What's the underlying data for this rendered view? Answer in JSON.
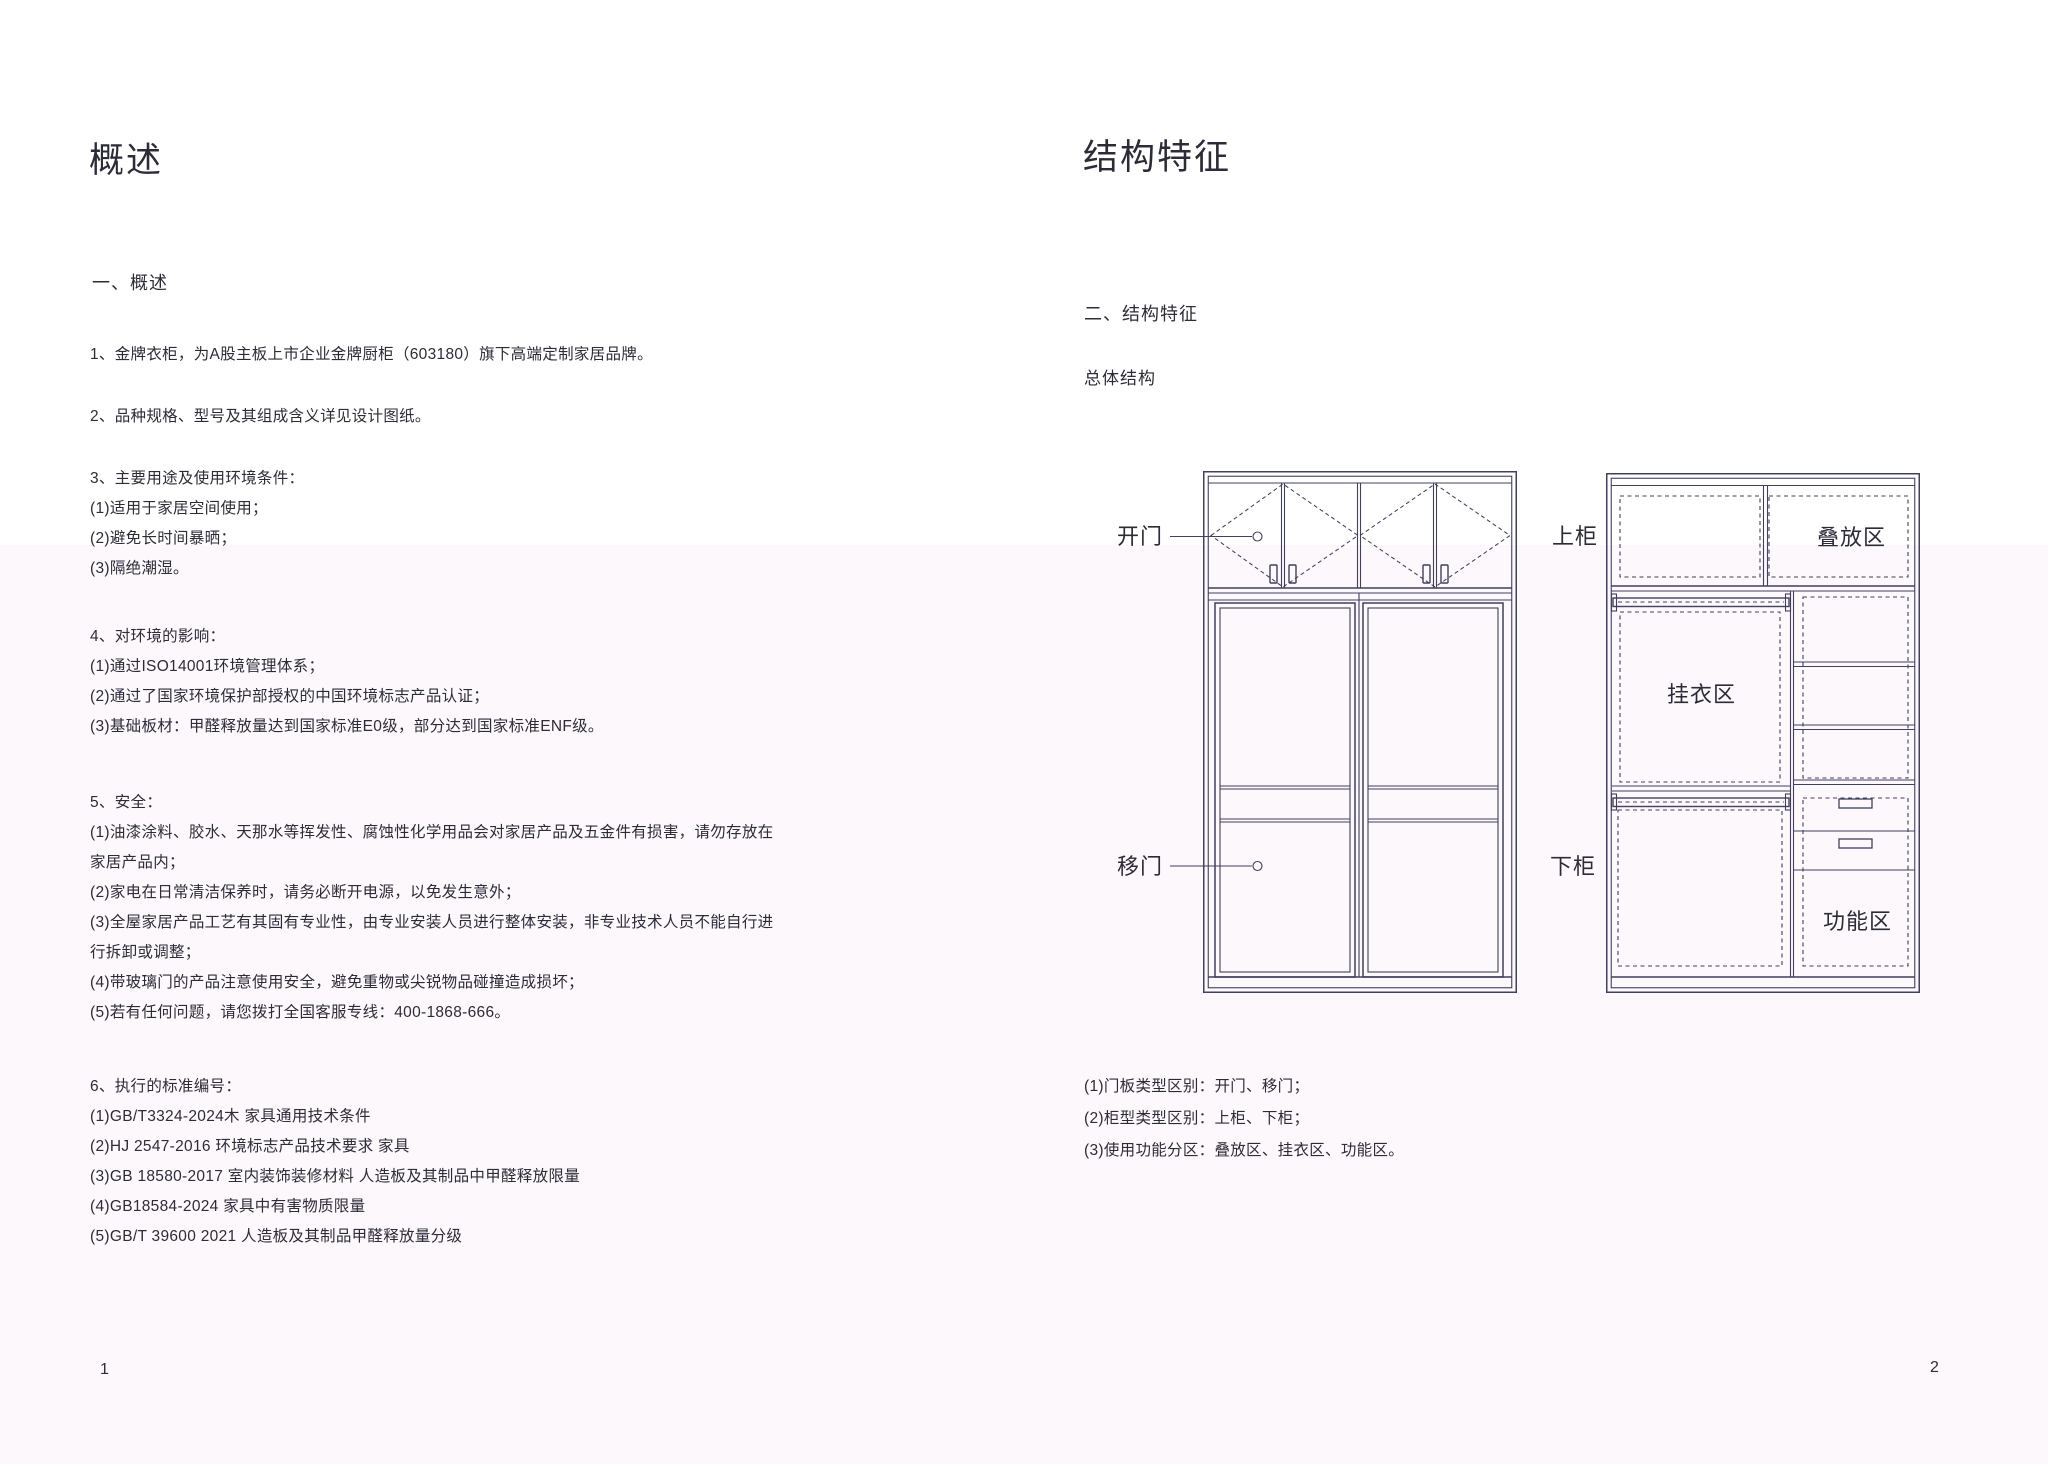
{
  "colors": {
    "background": "#ffffff",
    "tint_band": "#fdf8fb",
    "line": "#40405f",
    "text": "#2c2c38"
  },
  "left_page": {
    "title": "概述",
    "section_heading": "一、概述",
    "para1": "1、金牌衣柜，为A股主板上市企业金牌厨柜（603180）旗下高端定制家居品牌。",
    "para2": "2、品种规格、型号及其组成含义详见设计图纸。",
    "section3": {
      "heading": "3、主要用途及使用环境条件：",
      "items": [
        "(1)适用于家居空间使用；",
        "(2)避免长时间暴晒；",
        "(3)隔绝潮湿。"
      ]
    },
    "section4": {
      "heading": "4、对环境的影响：",
      "items": [
        "(1)通过ISO14001环境管理体系；",
        "(2)通过了国家环境保护部授权的中国环境标志产品认证；",
        "(3)基础板材：甲醛释放量达到国家标准E0级，部分达到国家标准ENF级。"
      ]
    },
    "section5": {
      "heading": "5、安全：",
      "lines": [
        "(1)油漆涂料、胶水、天那水等挥发性、腐蚀性化学用品会对家居产品及五金件有损害，请勿存放在",
        "家居产品内；",
        "(2)家电在日常清洁保养时，请务必断开电源，以免发生意外；",
        "(3)全屋家居产品工艺有其固有专业性，由专业安装人员进行整体安装，非专业技术人员不能自行进",
        "行拆卸或调整；",
        "(4)带玻璃门的产品注意使用安全，避免重物或尖锐物品碰撞造成损坏；",
        "(5)若有任何问题，请您拨打全国客服专线：400-1868-666。"
      ]
    },
    "section6": {
      "heading": "6、执行的标准编号：",
      "items": [
        "(1)GB/T3324-2024木 家具通用技术条件",
        "(2)HJ 2547-2016 环境标志产品技术要求 家具",
        "(3)GB 18580-2017 室内装饰装修材料 人造板及其制品中甲醛释放限量",
        "(4)GB18584-2024 家具中有害物质限量",
        "(5)GB/T 39600 2021 人造板及其制品甲醛释放量分级"
      ]
    },
    "page_number": "1"
  },
  "right_page": {
    "title": "结构特征",
    "section_heading": "二、结构特征",
    "subheading": "总体结构",
    "diagram_labels": {
      "swing_door": "开门",
      "sliding_door": "移门",
      "upper_cabinet": "上柜",
      "lower_cabinet": "下柜",
      "stacking_zone": "叠放区",
      "hanging_zone": "挂衣区",
      "function_zone": "功能区"
    },
    "notes": [
      "(1)门板类型区别：开门、移门；",
      "(2)柜型类型区别：上柜、下柜；",
      "(3)使用功能分区：叠放区、挂衣区、功能区。"
    ],
    "page_number": "2"
  }
}
